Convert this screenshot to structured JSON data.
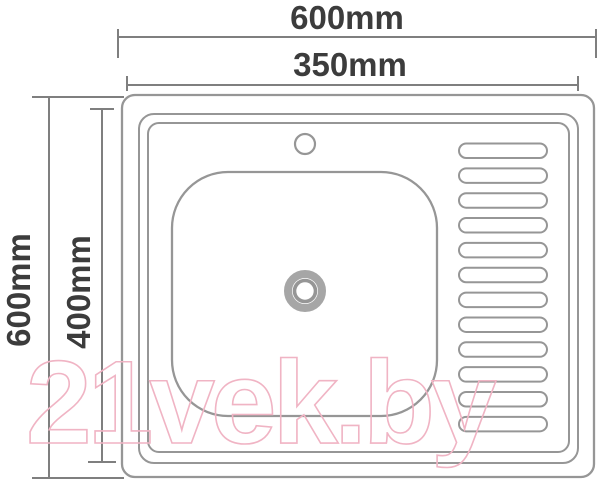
{
  "diagram": {
    "type": "sink-top-view-dimension-drawing",
    "dimensions": {
      "overall_width": "600mm",
      "inner_width": "350mm",
      "overall_depth": "600mm",
      "inner_depth": "400mm"
    },
    "watermark": "21vek.by",
    "drainboard": {
      "groove_count": 12
    },
    "parts": [
      "outer-edge",
      "rim-outer",
      "rim-inner",
      "basin",
      "faucet-hole",
      "drain",
      "drainboard-grooves"
    ],
    "colors": {
      "outline": "#969696",
      "outline_soft": "#a6a6a6",
      "dimension_lines": "#7f7f7f",
      "label_text": "#3c3c3c",
      "watermark": "#f0b4c4"
    }
  }
}
